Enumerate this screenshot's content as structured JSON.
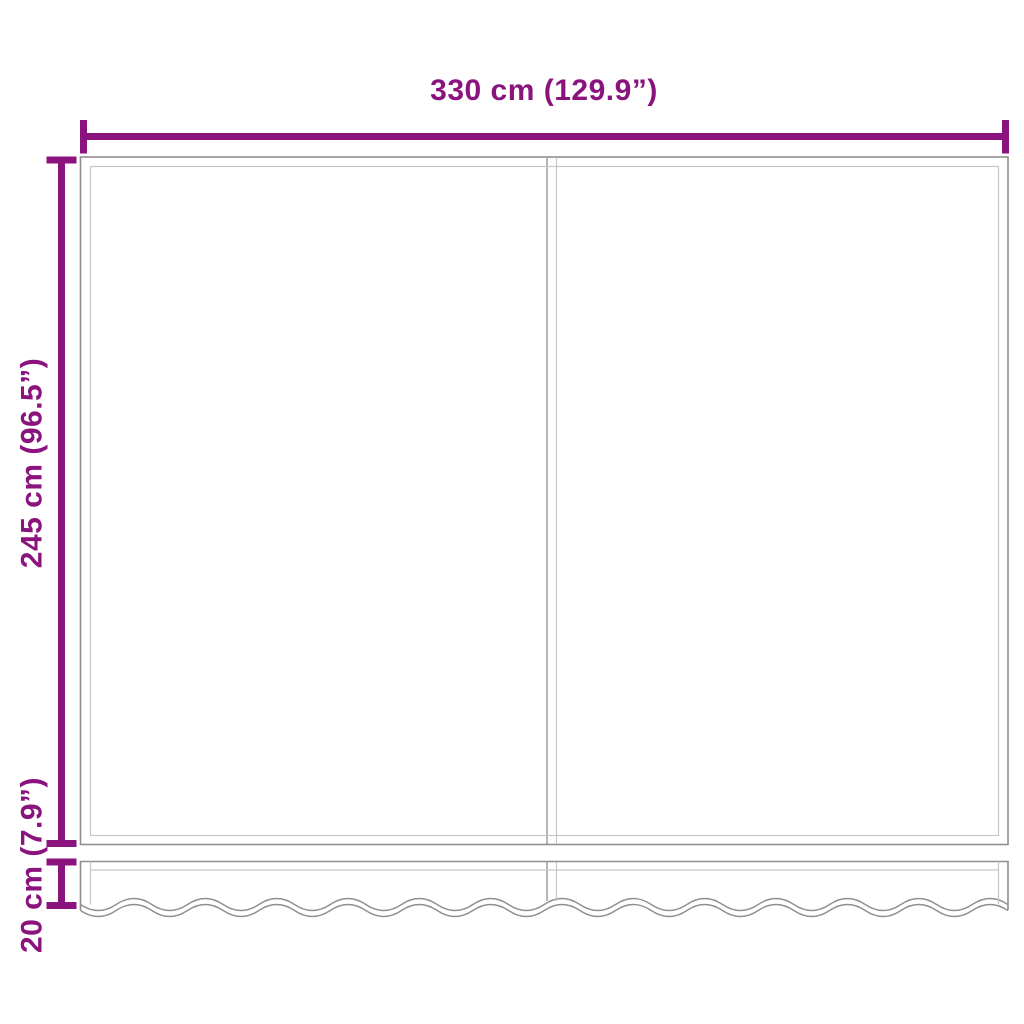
{
  "image": {
    "description": "Dimension diagram of replacement awning fabric with wavy valance",
    "background": "#ffffff"
  },
  "colors": {
    "accent": "#8a137e",
    "line_dark": "#8f8f8f",
    "line_light": "#c6c6c6"
  },
  "dimensions": {
    "width": {
      "label": "330 cm (129.9”)",
      "cm": 330,
      "inches": 129.9
    },
    "height": {
      "label": "245 cm (96.5”)",
      "cm": 245,
      "inches": 96.5
    },
    "valance": {
      "label": "20 cm (7.9”)",
      "cm": 20,
      "inches": 7.9
    }
  }
}
